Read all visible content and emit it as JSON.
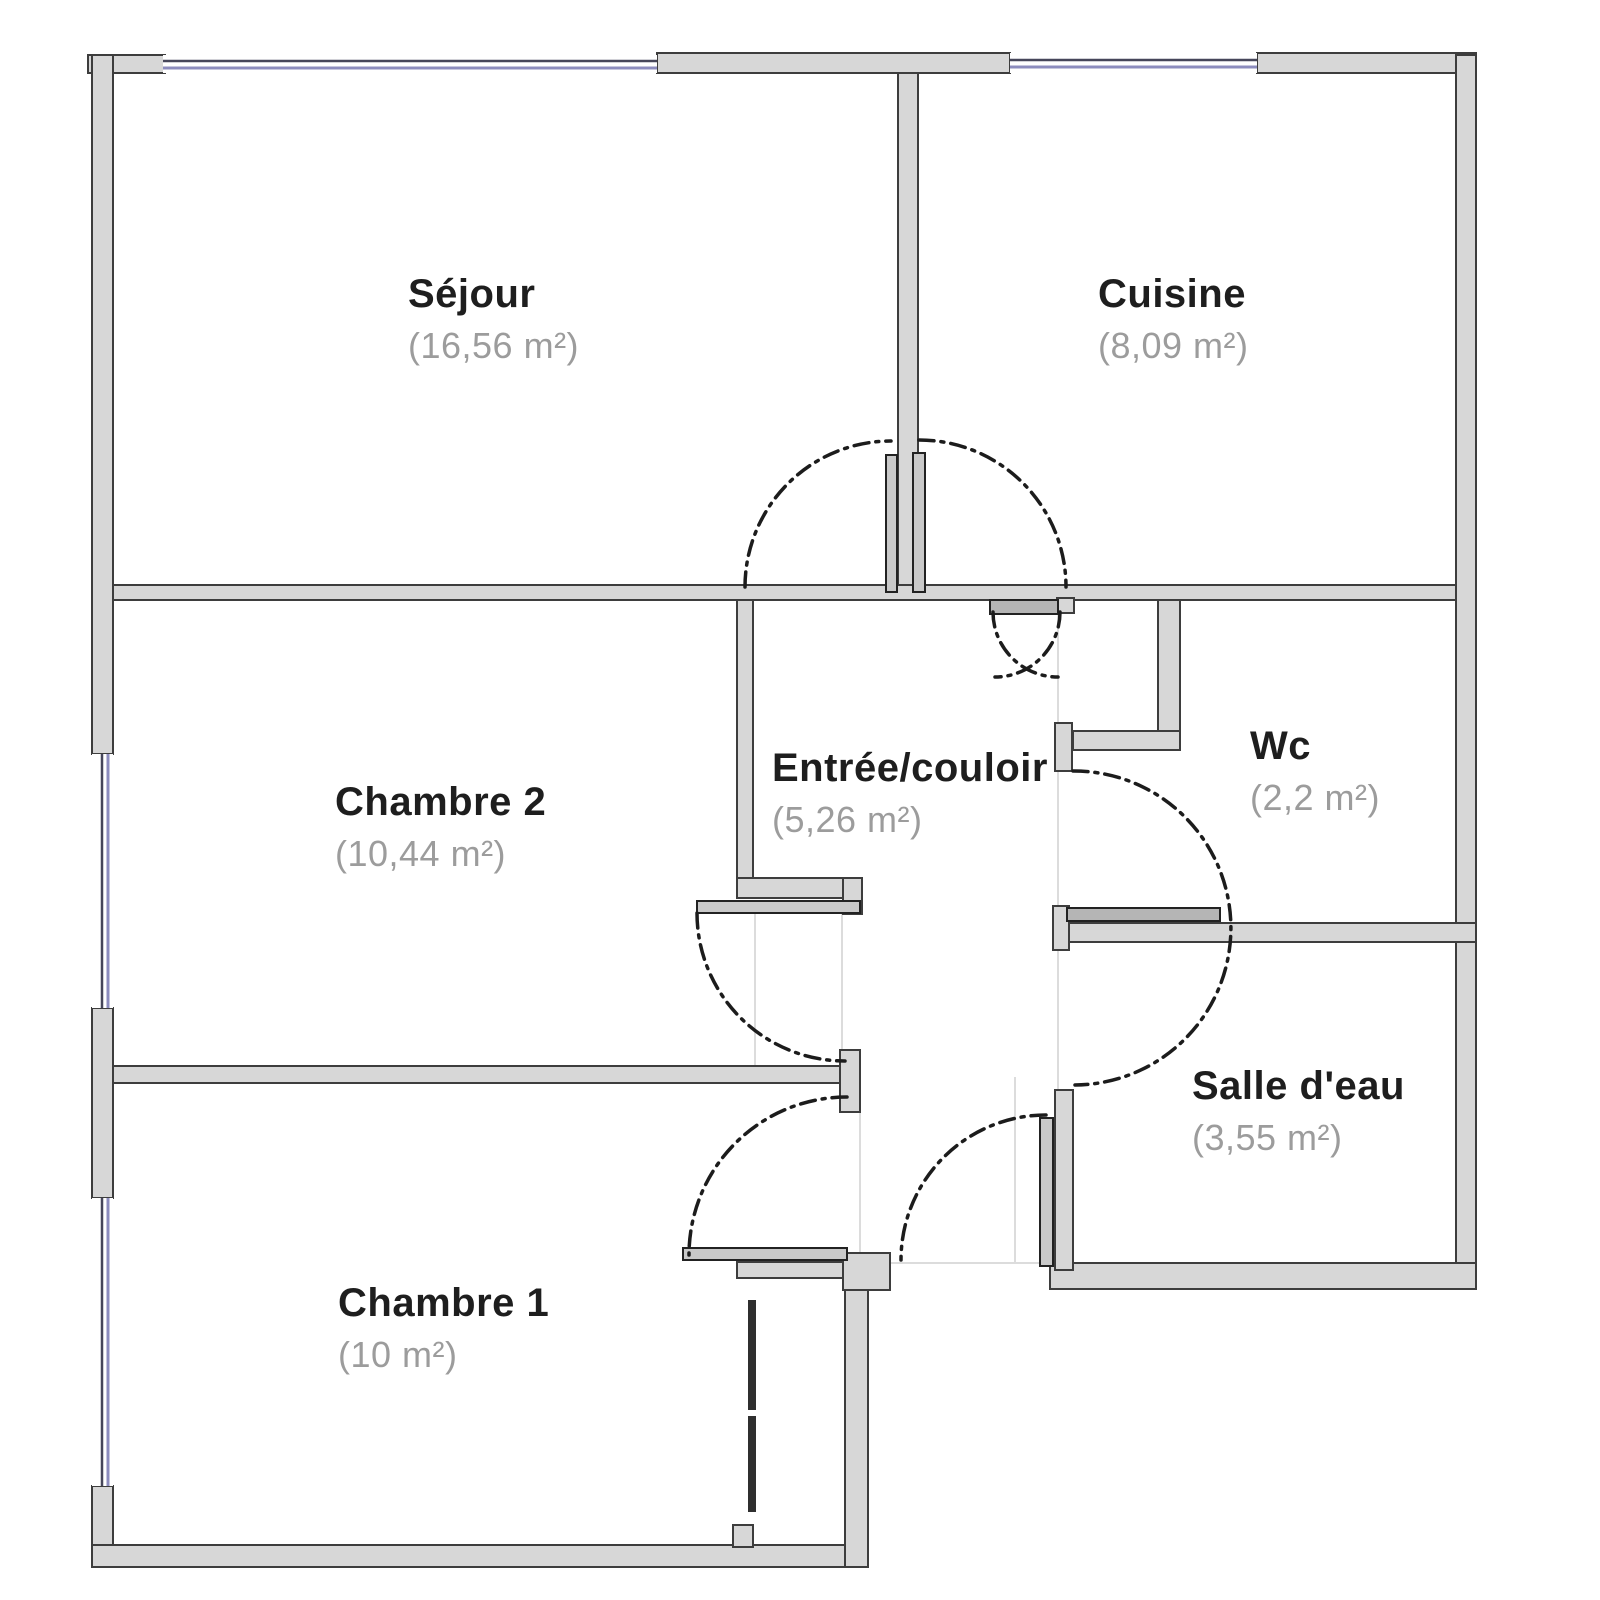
{
  "plan": {
    "rooms": [
      {
        "name": "Séjour",
        "area": "(16,56 m²)"
      },
      {
        "name": "Cuisine",
        "area": "(8,09 m²)"
      },
      {
        "name": "Chambre 2",
        "area": "(10,44 m²)"
      },
      {
        "name": "Entrée/couloir",
        "area": "(5,26 m²)"
      },
      {
        "name": "Wc",
        "area": "(2,2 m²)"
      },
      {
        "name": "Salle d'eau",
        "area": "(3,55 m²)"
      },
      {
        "name": "Chambre 1",
        "area": "(10 m²)"
      }
    ],
    "colors": {
      "background": "#ffffff",
      "wall_fill": "#d7d7d7",
      "wall_stroke": "#3d3d3d",
      "window_line": "#8c8cbe",
      "window_line_dark": "#46465a",
      "door_arc": "#1c1c1c",
      "door_leaf": "#c9c9c9",
      "door_leaf_dark": "#2f2f2f",
      "label": "#1e1e1e",
      "area_label": "#9c9c9c",
      "open_boundary": "#dcdcdc"
    }
  }
}
